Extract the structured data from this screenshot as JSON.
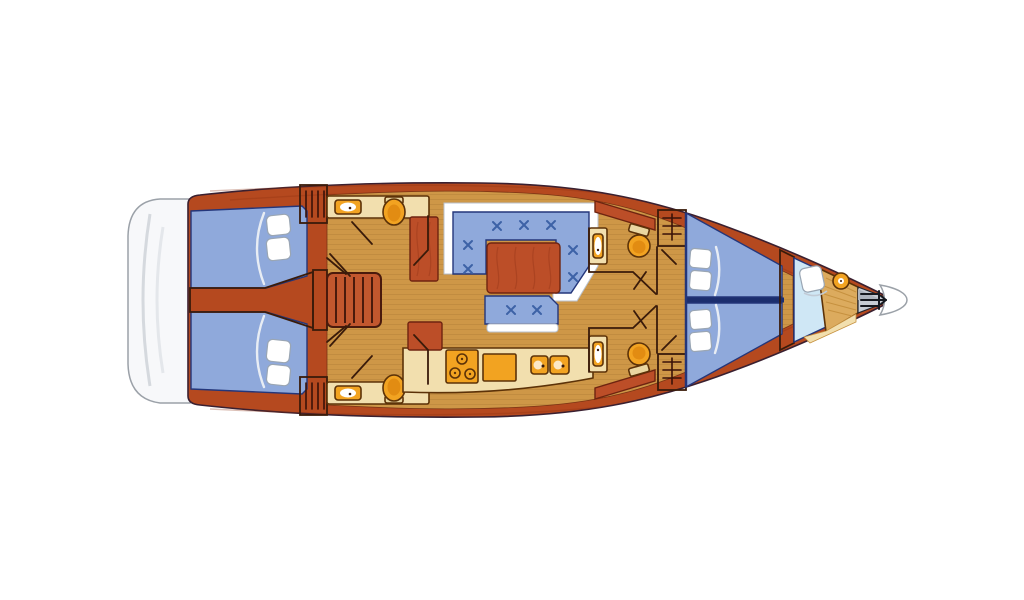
{
  "diagram": {
    "type": "sailboat-interior-deck-plan",
    "orientation": "bow-right-stern-left",
    "rooms": [
      {
        "id": "stern-platform",
        "name": "stern swim platform"
      },
      {
        "id": "aft-cabin-port",
        "name": "aft double cabin (port)",
        "features": [
          "double berth",
          "two pillows"
        ]
      },
      {
        "id": "aft-cabin-starboard",
        "name": "aft double cabin (starboard)",
        "features": [
          "double berth",
          "two pillows"
        ]
      },
      {
        "id": "companionway",
        "name": "companionway stairs and corridor"
      },
      {
        "id": "aft-head-port",
        "name": "aft head (port)",
        "features": [
          "sink",
          "toilet",
          "hanging locker"
        ]
      },
      {
        "id": "aft-head-starboard",
        "name": "aft head (starboard)",
        "features": [
          "sink",
          "toilet",
          "hanging locker"
        ]
      },
      {
        "id": "salon",
        "name": "salon",
        "features": [
          "U-settee with 7 cushion buttons",
          "wood table",
          "side bench with 2 buttons",
          "sideboards"
        ]
      },
      {
        "id": "galley",
        "name": "galley",
        "features": [
          "3-burner stove",
          "worktop",
          "double sink"
        ]
      },
      {
        "id": "mid-head-port",
        "name": "mid head (port)",
        "features": [
          "sink",
          "round toilet",
          "louvered locker"
        ]
      },
      {
        "id": "mid-head-starboard",
        "name": "mid head (starboard)",
        "features": [
          "sink",
          "round toilet",
          "louvered locker"
        ]
      },
      {
        "id": "forward-cabin",
        "name": "forward V-berth cabin",
        "features": [
          "two berths",
          "four pillows",
          "centerline divider"
        ]
      },
      {
        "id": "forepeak",
        "name": "forepeak",
        "features": [
          "seat pillow",
          "windlass",
          "anchor locker"
        ]
      },
      {
        "id": "bow",
        "name": "bow with anchor"
      }
    ],
    "fixture_counts": {
      "toilets": 4,
      "sinks_bath": 4,
      "galley_sinks": 2,
      "stove_burners": 3,
      "berth_pillows": 8,
      "cushion_buttons": 9
    }
  },
  "colors": {
    "background": "#ffffff",
    "hull": "#b5491f",
    "hull_dark": "#9e3318",
    "floor": "#ce9747",
    "floor_grain": "#be8a3e",
    "wood_furniture": "#bc4e28",
    "stairs_wood": "#c2572e",
    "upholstery": "#8fa9db",
    "berth_centerline": "#1c2e6e",
    "counter_cream": "#f2dfae",
    "tank_cream": "#ead6a0",
    "fixture_orange": "#f2a321",
    "fixture_inner": "#e28c12",
    "pale_blue": "#cfe7f5",
    "locker_tan": "#dcab5e",
    "platform_white": "#f7f8fa",
    "platform_shade": "#d5d9de",
    "gray_band": "#a0a4aa",
    "anchor_bg": "#c7ccd3",
    "anchor_glyph": "#16191f",
    "tip_white": "#ffffff"
  }
}
